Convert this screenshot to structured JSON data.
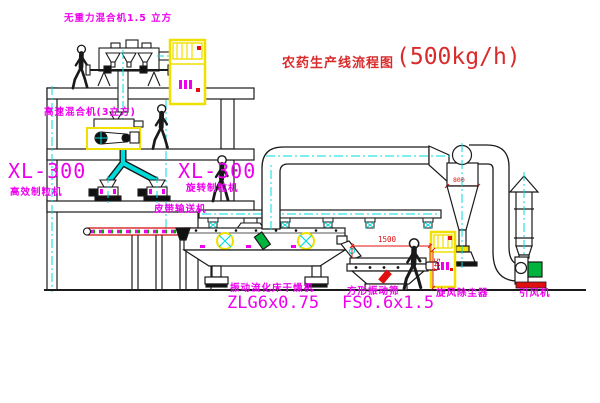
{
  "title": {
    "name": "农药生产线流程图",
    "capacity": "(500kg/h)"
  },
  "labels": {
    "gravity_mixer": "无重力混合机1.5 立方",
    "high_speed_mixer": "高速混合机(3立方)",
    "granulator_left_model": "XL-300",
    "granulator_left_name": "高效制粒机",
    "granulator_right_model": "XL-300",
    "granulator_right_name": "旋转制粒机",
    "belt_conveyor": "皮带输送机",
    "dryer_name": "振动流化床干燥机",
    "dryer_model": "ZLG6x0.75",
    "sieve_name": "方形振动筛",
    "sieve_model": "FS0.6x1.5",
    "cyclone_name": "旋风除尘器",
    "fan_name": "引风机"
  },
  "dimensions": {
    "sieve_length": "1500",
    "sieve_height": "541",
    "cyclone_band": "800"
  },
  "colors": {
    "label_magenta": "#ee00ee",
    "title_red": "#d92b2b",
    "dimension_red": "#e01010",
    "centerline_cyan": "#00dcdc",
    "cabinet_yellow": "#f0e000",
    "motor_green": "#00b33c",
    "line_black": "#1a1a1a",
    "background": "#ffffff"
  }
}
